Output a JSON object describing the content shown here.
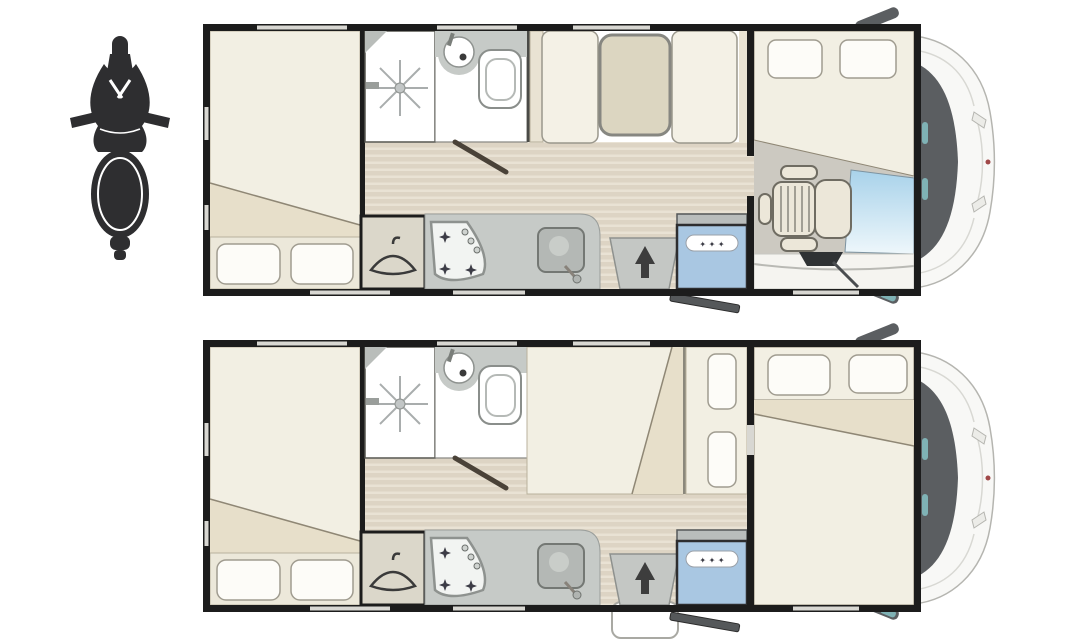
{
  "meta": {
    "canvas": {
      "width": 1080,
      "height": 644
    },
    "subject": "motorhome-floorplan-two-layouts-with-scooter-icon"
  },
  "colors": {
    "background": "#ffffff",
    "wall": "#1c1c1c",
    "window-gap": "#d8d7d2",
    "room-white": "#ffffff",
    "mattress": "#f2efe3",
    "mattress-fold": "#e7dfca",
    "mattress-edge": "#8f8775",
    "pillow": "#fdfcf8",
    "pillow-edge": "#a09c90",
    "pillow-strip": "#ece8da",
    "floor": "#ddd4c4",
    "floor-stripe": "#e9e2d4",
    "counter": "#c6cac7",
    "cabinet": "#e9e3d3",
    "seat": "#f4f1e6",
    "table": "#dcd6c1",
    "wardrobe": "#dbd7ca",
    "appliance-gray": "#b9bdbc",
    "fridge": "#a9c7e2",
    "fridge-edge": "#2d2d2f",
    "step": "#c4c7c4",
    "arrow": "#3d3d3d",
    "cab-floor": "#ccc9c1",
    "hood": "#f5f4f0",
    "windshield-top": "#a8d2ea",
    "windshield-bottom": "#eef7fb",
    "vehicle-body": "#f8f8f6",
    "vehicle-line": "#b5b5b0",
    "vehicle-dark": "#5b5e61",
    "mirror-glass": "#7fb2b5",
    "scooter": "#2e2e30",
    "door-bar": "#55585a",
    "star": "#3c3c46",
    "fixture-edge": "#747874"
  },
  "fridge-stars": "✦ ✦ ✦",
  "scooter": {
    "icon": "scooter-top-view"
  },
  "plans": [
    {
      "id": "plan-day",
      "rooms": [
        "rear-bedroom",
        "shower",
        "bathroom",
        "wardrobe",
        "kitchen",
        "dinette-with-table",
        "entrance-step",
        "fridge",
        "cab-swivel-seat",
        "overcab-bed"
      ]
    },
    {
      "id": "plan-night",
      "rooms": [
        "rear-bedroom",
        "shower",
        "bathroom",
        "wardrobe",
        "kitchen",
        "converted-dinette-bed",
        "entrance-step",
        "fridge",
        "dropdown-front-bed"
      ]
    }
  ]
}
